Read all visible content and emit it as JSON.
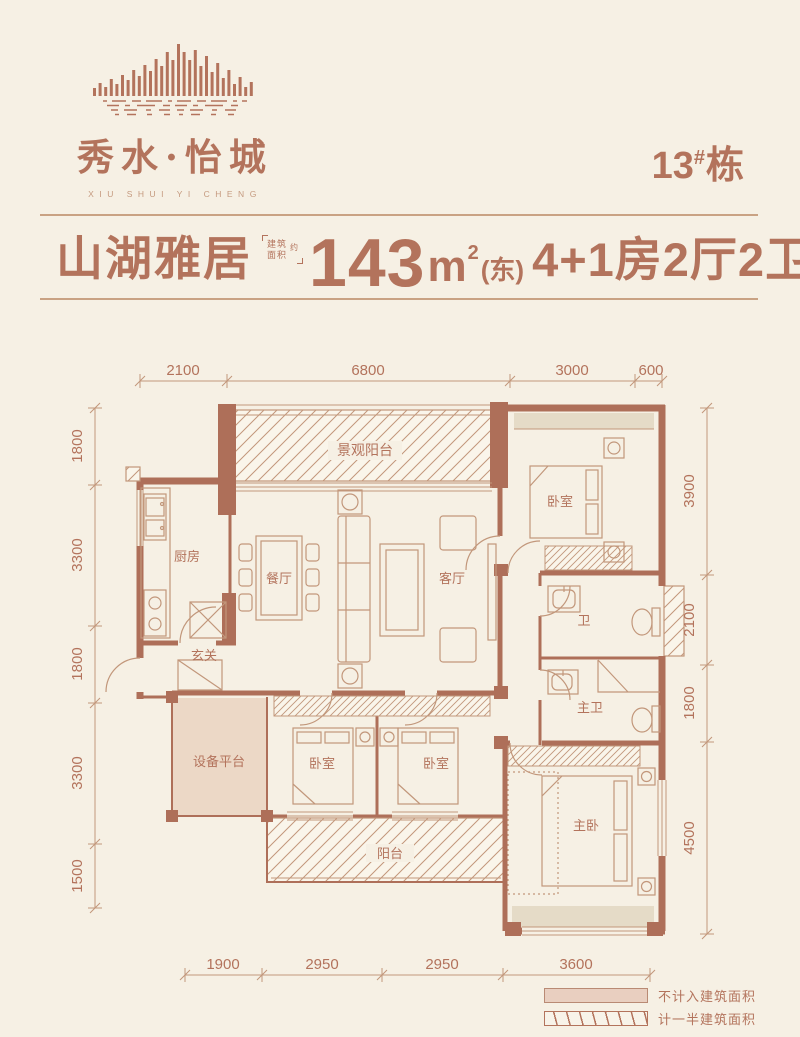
{
  "brand": {
    "name": "秀水·怡城",
    "name_en": "XIU SHUI YI CHENG",
    "building_no": "13",
    "building_hash": "#",
    "building_unit": "栋"
  },
  "title": {
    "name": "山湖雅居",
    "area_note_top": "建筑",
    "area_note_bottom": "面积",
    "area_note_side": "约",
    "area_value": "143",
    "area_unit": "m",
    "area_sup": "2",
    "orientation": "(东)",
    "layout": "4+1房2厅2卫"
  },
  "dims": {
    "top": [
      "2100",
      "6800",
      "3000",
      "600"
    ],
    "bottom": [
      "1900",
      "2950",
      "2950",
      "3600"
    ],
    "left": [
      "1800",
      "3300",
      "1800",
      "3300",
      "1500"
    ],
    "right": [
      "3900",
      "2100",
      "1800",
      "4500"
    ]
  },
  "rooms": {
    "view_balcony": "景观阳台",
    "bedroom_ne": "卧室",
    "kitchen": "厨房",
    "dining": "餐厅",
    "living": "客厅",
    "foyer": "玄关",
    "bath": "卫",
    "master_bath": "主卫",
    "equipment": "设备平台",
    "bedroom_sw": "卧室",
    "bedroom_s": "卧室",
    "master_bedroom": "主卧",
    "balcony": "阳台"
  },
  "legend": {
    "items": [
      {
        "label": "不计入建筑面积"
      },
      {
        "label": "计一半建筑面积"
      }
    ]
  },
  "colors": {
    "background": "#f6f0e4",
    "wall": "#ae6f59",
    "line": "#c2977b",
    "text": "#b3735c",
    "fill_tan": "#ecd8c6",
    "fill_bay": "#e5dbc7",
    "fill_legend": "#e9cfc0"
  }
}
